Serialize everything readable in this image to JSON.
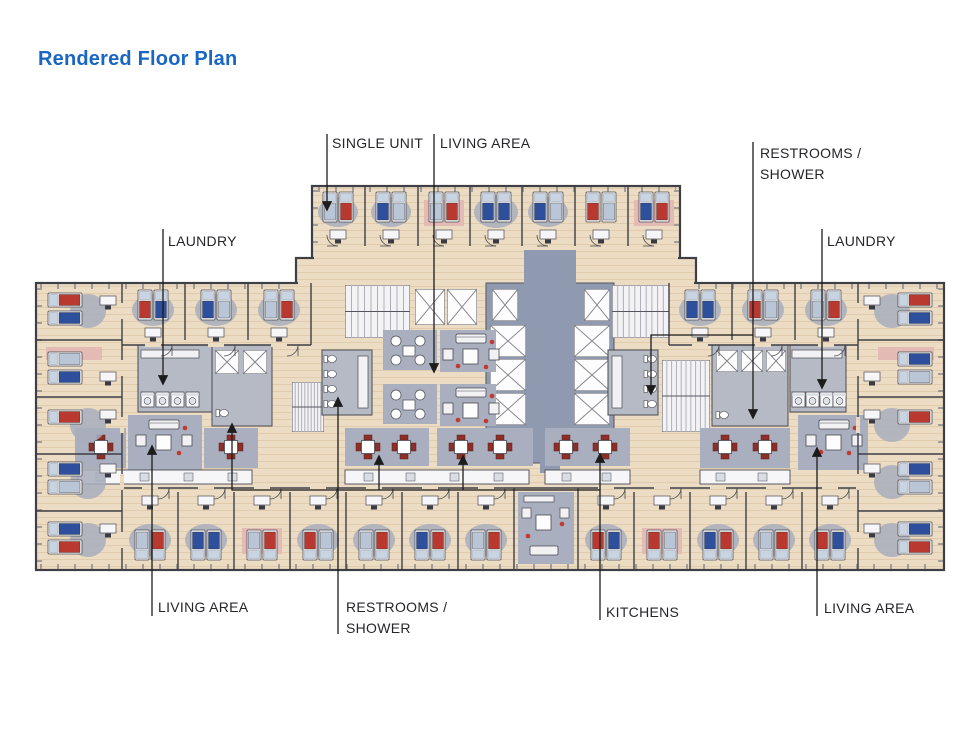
{
  "page": {
    "title": "Rendered Floor Plan"
  },
  "labels": [
    {
      "id": "single-unit",
      "lines": [
        "SINGLE UNIT"
      ]
    },
    {
      "id": "living-area-top",
      "lines": [
        "LIVING AREA"
      ]
    },
    {
      "id": "restrooms-shower-right",
      "lines": [
        "RESTROOMS /",
        "SHOWER"
      ]
    },
    {
      "id": "laundry-left",
      "lines": [
        "LAUNDRY"
      ]
    },
    {
      "id": "laundry-right",
      "lines": [
        "LAUNDRY"
      ]
    },
    {
      "id": "living-area-bottom-left",
      "lines": [
        "LIVING AREA"
      ]
    },
    {
      "id": "restrooms-shower-bottom",
      "lines": [
        "RESTROOMS /",
        "SHOWER"
      ]
    },
    {
      "id": "kitchens",
      "lines": [
        "KITCHENS"
      ]
    },
    {
      "id": "living-area-bottom-right",
      "lines": [
        "LIVING AREA"
      ]
    }
  ],
  "palette": {
    "title_blue": "#1966c4",
    "bed_red": "#b9382f",
    "bed_blue": "#2d4f9c",
    "bed_light": "#b9c6d8",
    "floor_tan": "#ecdcc3",
    "carpet_gray": "#a9afbe",
    "core_blue": "#8f9ab0",
    "bath_gray": "#b6bac5",
    "wall_dark": "#3f3f46",
    "chair_red": "#8c2f28",
    "dot_red": "#c1392f",
    "leader_line": "#1c1c1c"
  }
}
